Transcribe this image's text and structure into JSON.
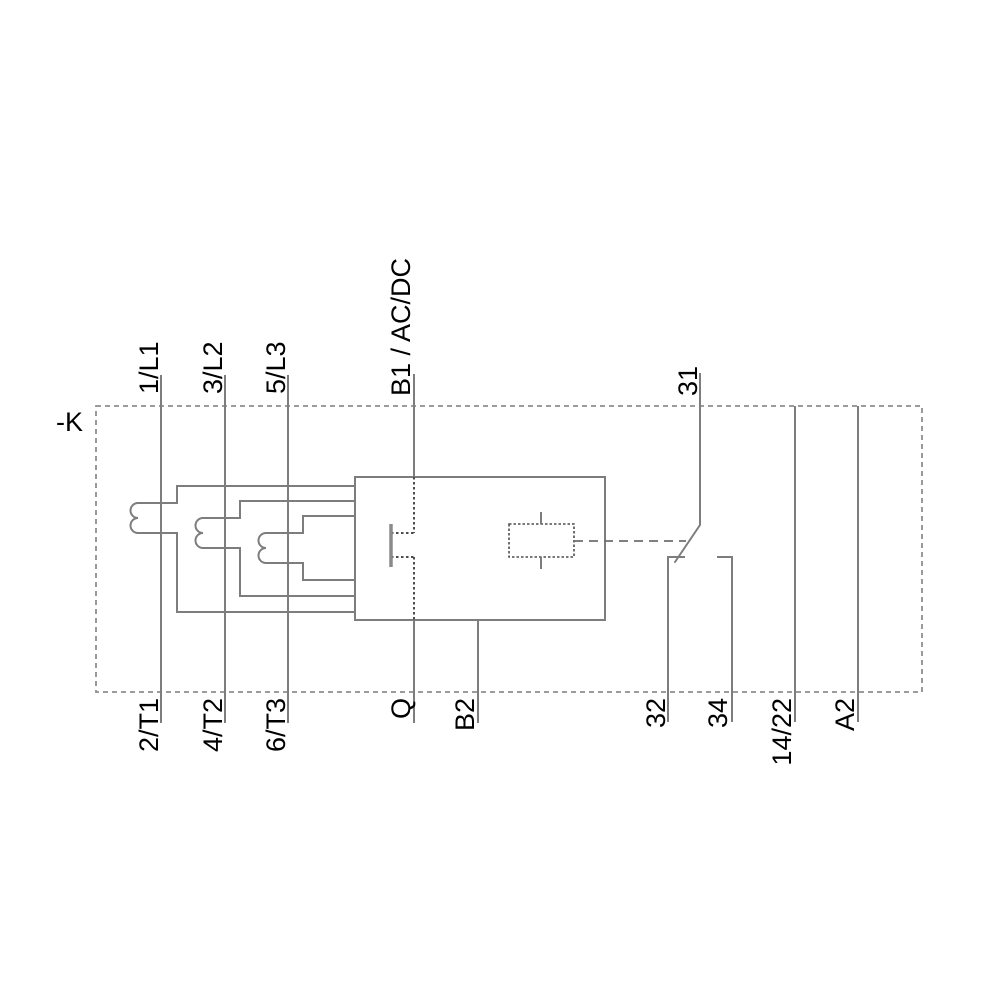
{
  "diagram": {
    "type": "wiring-schematic",
    "description": "Overload / monitoring relay circuit diagram with three measured phases, control circuit and changeover auxiliary contact",
    "labels": {
      "device": "-K",
      "l1_in": "1/L1",
      "l2_in": "3/L2",
      "l3_in": "5/L3",
      "control_in": "B1 / AC/DC",
      "aux_common": "31",
      "t1_out": "2/T1",
      "t2_out": "4/T2",
      "t3_out": "6/T3",
      "q_out": "Q",
      "control_out": "B2",
      "aux_nc": "32",
      "aux_no": "34",
      "loop_out": "14/22",
      "coil_a2": "A2"
    },
    "colors": {
      "line": "#7d7d7d",
      "frame_dash": "#8e8e8e",
      "detail_dash": "#4d4d4d",
      "text": "#000000",
      "background": "#ffffff"
    }
  }
}
